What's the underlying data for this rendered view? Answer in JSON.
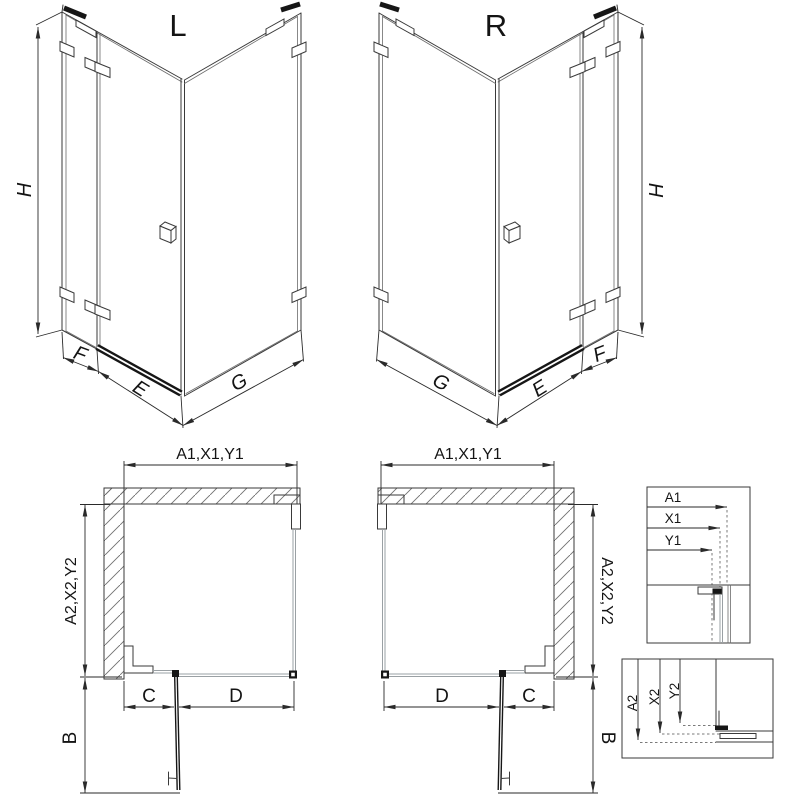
{
  "iso_left": {
    "label": "L",
    "dim_height": "H",
    "dim_f": "F",
    "dim_e": "E",
    "dim_g": "G"
  },
  "iso_right": {
    "label": "R",
    "dim_height": "H",
    "dim_f": "F",
    "dim_e": "E",
    "dim_g": "G"
  },
  "plan_left": {
    "dim_top": "A1,X1,Y1",
    "dim_side": "A2,X2,Y2",
    "dim_c": "C",
    "dim_d": "D",
    "dim_b": "B"
  },
  "plan_right": {
    "dim_top": "A1,X1,Y1",
    "dim_side": "A2,X2,Y2",
    "dim_c": "C",
    "dim_d": "D",
    "dim_b": "B"
  },
  "detail_top": {
    "dim_a1": "A1",
    "dim_x1": "X1",
    "dim_y1": "Y1"
  },
  "detail_bottom": {
    "dim_a2": "A2",
    "dim_x2": "X2",
    "dim_y2": "Y2"
  },
  "colors": {
    "line": "#3a3a3a",
    "glass": "#9aa0a4",
    "dark": "#161616",
    "background": "#ffffff"
  }
}
